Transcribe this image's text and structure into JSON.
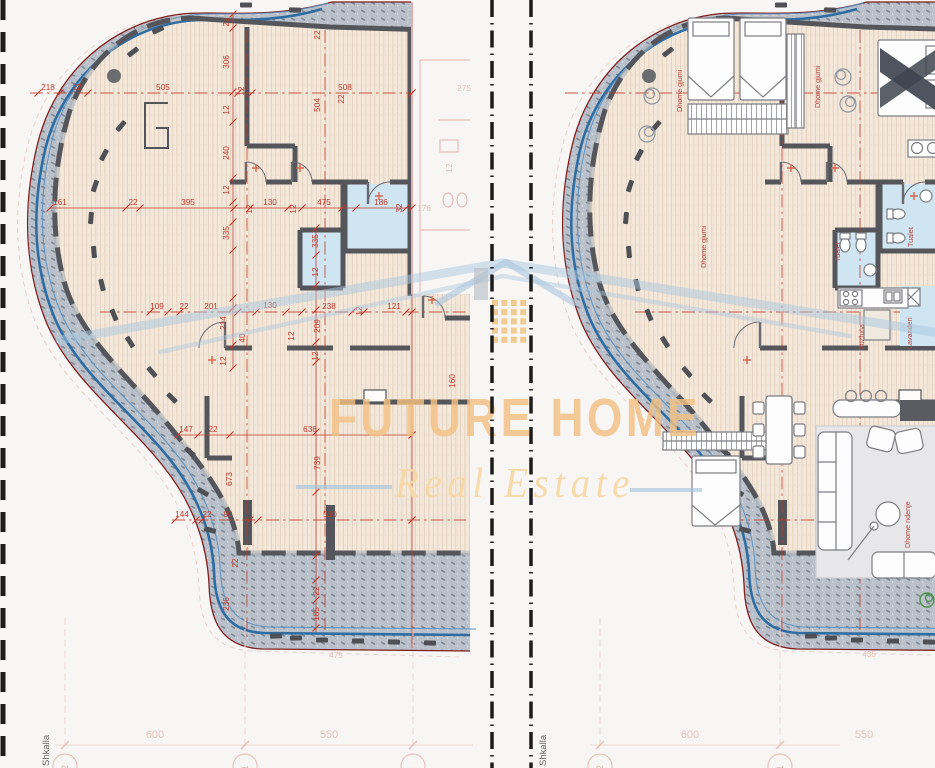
{
  "watermark": {
    "line1": "FUTURE HOME",
    "line2": "Real Estate"
  },
  "colors": {
    "dimension_red": "#c0392b",
    "label_red": "#b5443c",
    "wall_gray": "#55565b",
    "railing_blue": "#2e6da4",
    "outer_maroon": "#7e1f1f",
    "balcony_gray": "#bac1ca",
    "floor_beige": "#f4e8db",
    "bath_blue": "#cfe5f2",
    "brand_orange": "#f3c183",
    "brand_light": "#f7d9a6",
    "roof_blue": "#aac7df",
    "grid_pink": "#e6c0ba"
  },
  "panel_left": {
    "type_label": "dimensioned-plan",
    "scale_label": "Shkalla",
    "grid_dims": [
      [
        "600",
        155,
        738
      ],
      [
        "550",
        329,
        738
      ]
    ],
    "grid_bubbles": [
      [
        "12",
        65,
        766
      ],
      [
        "11",
        245,
        766
      ],
      [
        "9",
        413,
        766
      ]
    ],
    "dims_h": [
      [
        "218",
        48,
        90
      ],
      [
        "22",
        77,
        90
      ],
      [
        "505",
        163,
        90
      ],
      [
        "508",
        345,
        90
      ],
      [
        "161",
        60,
        205
      ],
      [
        "22",
        133,
        205
      ],
      [
        "395",
        188,
        205
      ],
      [
        "130",
        270,
        205
      ],
      [
        "475",
        324,
        205
      ],
      [
        "186",
        381,
        205
      ],
      [
        "109",
        157,
        309
      ],
      [
        "22",
        184,
        309
      ],
      [
        "201",
        211,
        309
      ],
      [
        "130",
        270,
        308
      ],
      [
        "238",
        329,
        309
      ],
      [
        "121",
        394,
        309
      ],
      [
        "147",
        186,
        432
      ],
      [
        "22",
        213,
        432
      ],
      [
        "638",
        310,
        432
      ],
      [
        "144",
        182,
        517
      ],
      [
        "22",
        207,
        517
      ],
      [
        "90",
        228,
        517
      ],
      [
        "510",
        330,
        517
      ]
    ],
    "dims_v": [
      [
        "22",
        229,
        22
      ],
      [
        "306",
        229,
        62
      ],
      [
        "12",
        229,
        110
      ],
      [
        "240",
        229,
        153
      ],
      [
        "12",
        229,
        190
      ],
      [
        "335",
        229,
        233
      ],
      [
        "12",
        244,
        91
      ],
      [
        "22",
        320,
        35
      ],
      [
        "504",
        320,
        105
      ],
      [
        "22",
        344,
        99
      ],
      [
        "12",
        252,
        209
      ],
      [
        "12",
        296,
        209
      ],
      [
        "32",
        402,
        208
      ],
      [
        "335",
        318,
        241
      ],
      [
        "12",
        318,
        272
      ],
      [
        "214",
        226,
        323
      ],
      [
        "12",
        226,
        361
      ],
      [
        "40",
        245,
        338
      ],
      [
        "12",
        294,
        336
      ],
      [
        "209",
        320,
        326
      ],
      [
        "12",
        318,
        356
      ],
      [
        "12",
        362,
        311
      ],
      [
        "160",
        455,
        381
      ],
      [
        "739",
        320,
        463
      ],
      [
        "673",
        232,
        479
      ],
      [
        "22",
        238,
        563
      ],
      [
        "236",
        229,
        604
      ],
      [
        "22",
        319,
        591
      ],
      [
        "185",
        319,
        614
      ]
    ],
    "ghost_texts": [
      [
        "275",
        464,
        91,
        0
      ],
      [
        "12",
        452,
        168,
        -90
      ],
      [
        "176",
        424,
        211,
        0
      ],
      [
        "475",
        336,
        658,
        0
      ]
    ]
  },
  "panel_right": {
    "type_label": "furnished-plan",
    "scale_label": "Shkalla",
    "grid_dims": [
      [
        "600",
        690,
        738
      ],
      [
        "550",
        864,
        738
      ]
    ],
    "grid_bubbles": [
      [
        "12",
        600,
        766
      ],
      [
        "11",
        780,
        766
      ]
    ],
    "room_labels": [
      [
        "Dhome gjumi",
        682,
        112
      ],
      [
        "Dhome gjumi",
        820,
        108
      ],
      [
        "Dhome gjumi",
        706,
        268
      ],
      [
        "Tualet",
        840,
        262
      ],
      [
        "Tualet",
        913,
        247
      ],
      [
        "Kuzhina",
        864,
        350
      ],
      [
        "Lavanderi",
        912,
        349
      ],
      [
        "Dhome ndenje",
        910,
        548
      ]
    ],
    "ghost_texts": [
      [
        "435",
        869,
        657,
        0
      ]
    ]
  }
}
